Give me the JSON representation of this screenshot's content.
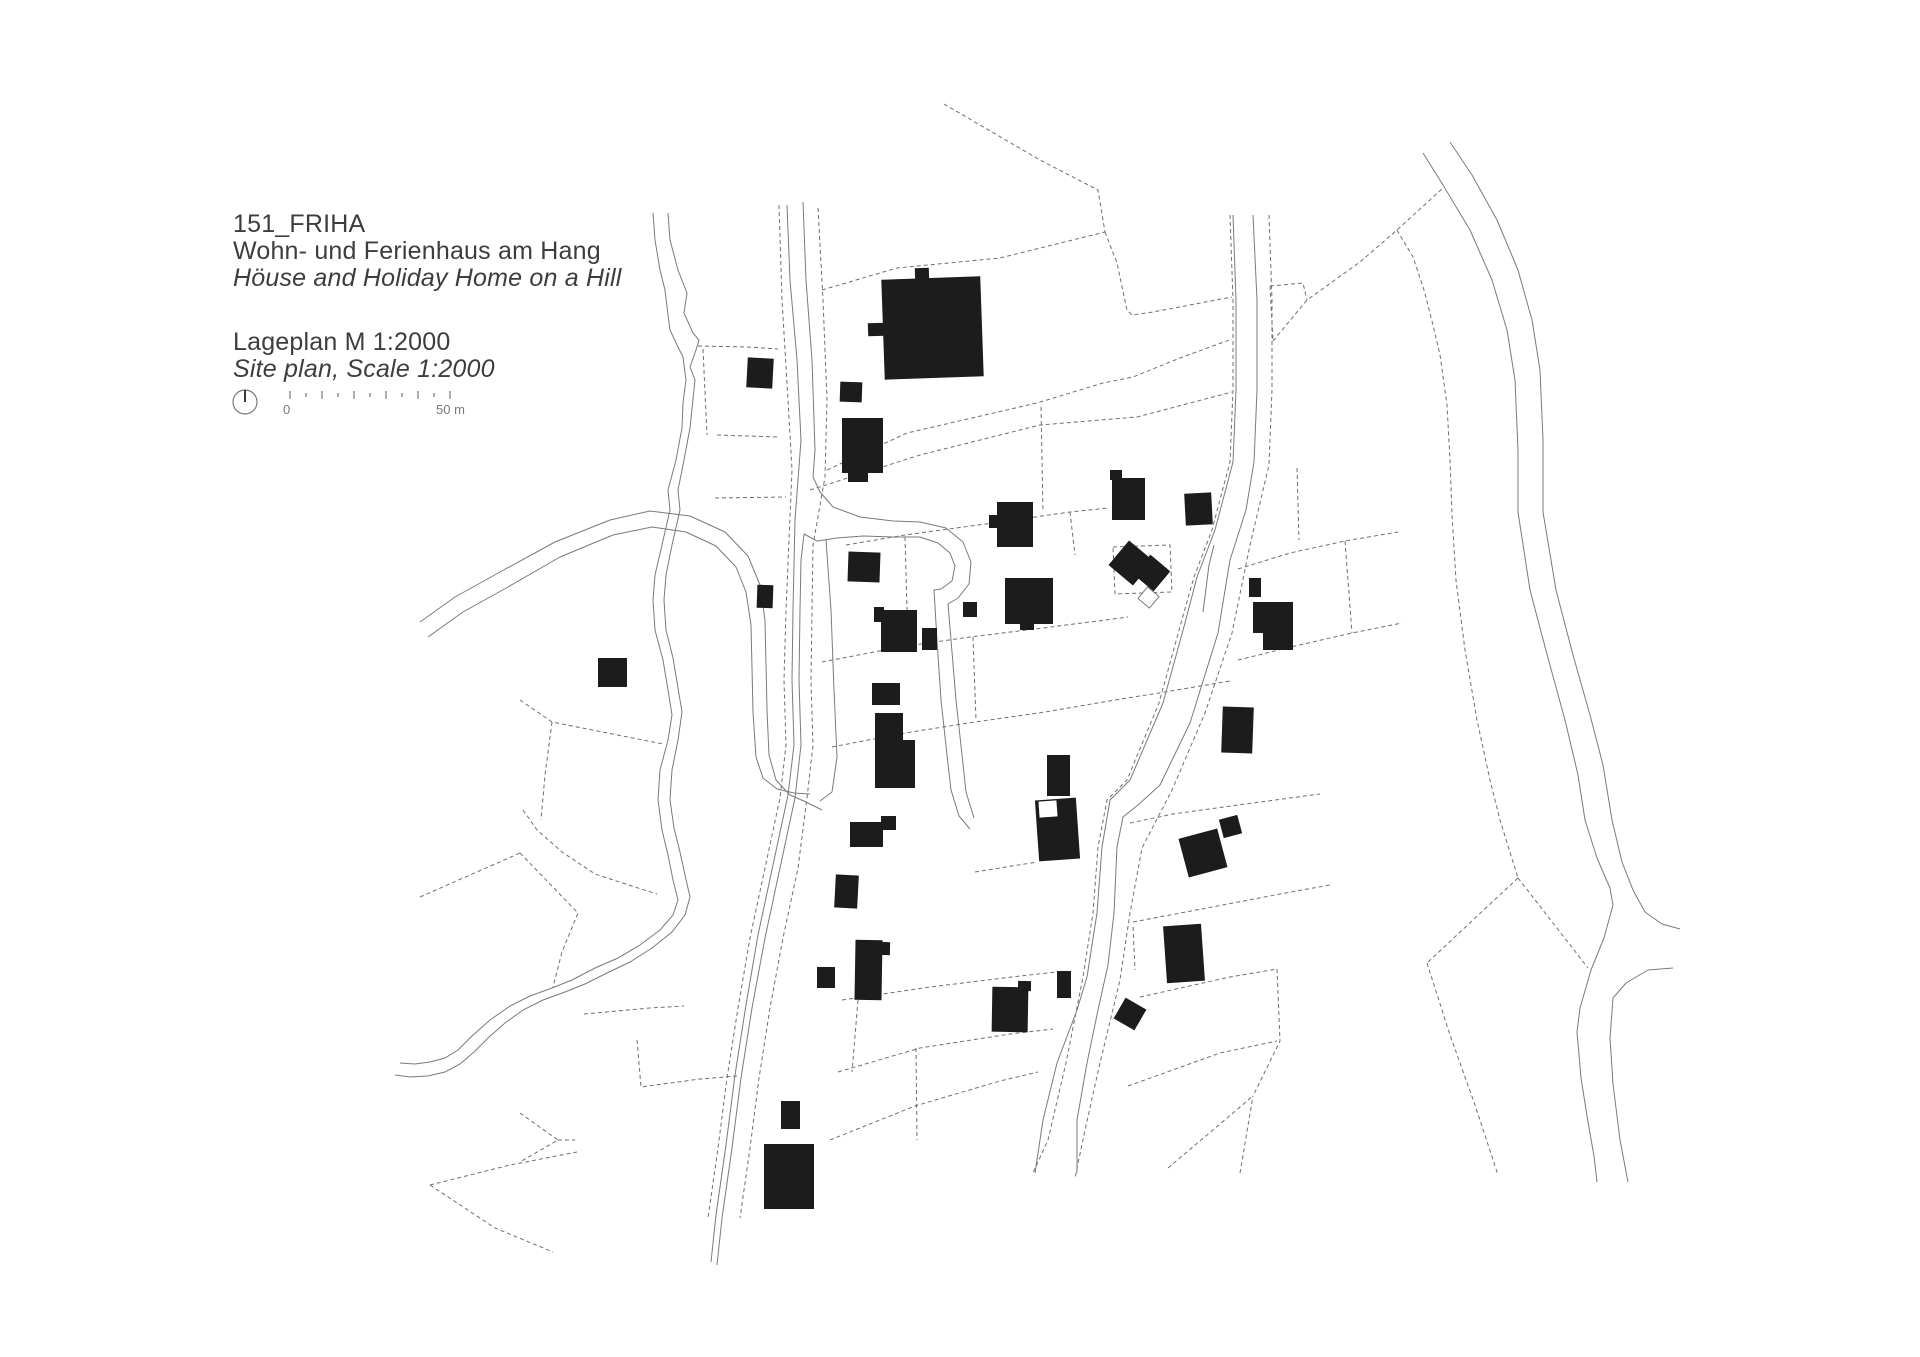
{
  "title_block": {
    "project_id": "151_FRIHA",
    "subtitle_de": "Wohn- und Ferienhaus am Hang",
    "subtitle_en": "Höuse and Holiday Home on a Hill",
    "plan_label_de": "Lageplan M 1:2000",
    "plan_label_en": "Site plan, Scale 1:2000"
  },
  "scale_bar": {
    "start_label": "0",
    "end_label": "50 m",
    "tick_count": 11,
    "x_start": 290,
    "tick_step": 16,
    "y_base": 399,
    "tall_tick_h": 8,
    "short_tick_h": 4
  },
  "north_arrow": {
    "cx": 245,
    "cy": 402,
    "r": 12
  },
  "colors": {
    "line": "#7a7a7a",
    "dashed_line": "#6f6f6f",
    "building": "#1c1c1c",
    "text": "#3d3d3d",
    "scale_text": "#787878",
    "background": "#ffffff"
  },
  "drawing": {
    "width": 1920,
    "height": 1357,
    "streams": [
      "M653,213 L655,240 L660,270 L665,290 L667,307 L670,330 L678,347 L683,357 L686,380 L683,403 L682,428 L676,460 L668,490 L670,510 L662,545 L655,575 L653,600 L655,630 L663,660 L668,690 L672,715 L668,740 L660,770 L658,800 L662,830 L668,855 L673,880 L678,900 L673,915 L660,930 L640,945 L618,958 L595,968 L572,980 L552,988 L530,996 L510,1006 L490,1020 L472,1036 L458,1050 L445,1058 L430,1062 L415,1064 L400,1063",
      "M668,213 L670,240 L678,270 L687,293 L684,313 L693,333 L699,340 L696,350 L690,367 L695,380 L690,428 L684,460 L678,490 L680,510 L672,545 L666,575 L664,600 L666,630 L673,658 L678,688 L682,712 L678,740 L672,770 L670,800 L674,828 L680,852 L685,875 L690,897 L685,915 L672,932 L652,948 L630,962 L607,973 L585,984 L565,992 L543,1000 L523,1010 L505,1023 L488,1038 L474,1052 L460,1064 L445,1072 L428,1076 L410,1077 L395,1075"
    ],
    "roads": [
      "M787,205 L790,280 L797,360 L801,440 L798,480 L795,520 L793,610 L792,680 L794,745 L788,795 L773,865 L758,935 L746,1005 L735,1075 L726,1145 L716,1215 L711,1262",
      "M803,202 L806,280 L812,360 L815,450 L813,477 L820,492 L833,507 L860,517 L893,521 L920,522",
      "M920,537 L893,537 L863,536 L837,538 L817,541 L804,534 L801,560 L800,610 L799,680 L801,745 L795,798 L780,868 L765,938 L752,1008 L741,1078 L732,1148 L722,1218 L717,1265",
      "M920,522 L946,528 L963,542 L971,562 L969,584 L958,598 L948,604 L951,640 L956,700 L962,755 L966,792 L974,818",
      "M920,537 L938,543 L950,553 L955,566 L952,581 L941,589 L934,590 L937,640 L941,700 L947,755 L951,790 L959,816 L970,829",
      "M826,540 L831,610 L834,690 L837,757 L832,792 L820,801",
      "M1233,215 L1236,300 L1236,390 L1233,462 L1215,530 L1197,577 L1185,623 L1163,703 L1130,780 L1110,800 L1102,847 L1097,913 L1087,977 L1077,1010 L1057,1063 L1043,1120 L1035,1173",
      "M1253,215 L1257,300 L1257,390 L1254,462 L1246,510 L1230,560 L1218,633 L1190,723 L1160,785 L1138,805 L1123,817 L1117,847 L1114,913 L1108,965 L1098,1010 L1087,1063 L1077,1120 L1077,1173",
      "M1203,612 L1209,565 L1214,545",
      "M1423,153 L1443,185 L1470,230 L1492,280 L1507,330 L1515,380 L1518,450 L1518,512 L1530,590 L1548,658 L1565,720 L1578,775 L1585,820 L1597,858 L1610,888 L1613,905 L1604,938 L1591,970 L1580,1008 L1577,1032 L1581,1078 L1588,1122 L1594,1156 L1597,1182",
      "M1450,142 L1472,175 L1497,220 L1518,270 L1532,320 L1540,370 L1543,440 L1543,512 L1556,590 L1573,655 L1590,715 L1603,765 L1612,820 L1622,862 L1633,890 L1645,912 L1662,924 L1680,929",
      "M1673,968 L1648,970 L1626,983 L1613,998 L1610,1038 L1613,1084 L1620,1140 L1628,1182",
      "M420,622 L455,597 L500,572 L555,542 L610,520 L650,511 L690,516 L725,532 L748,556 L760,585 L765,620 L766,665 L767,710 L769,755 L776,780 L790,795 L806,802 L822,810",
      "M428,637 L463,612 L508,587 L560,557 L613,535 L652,527 L686,532 L716,546 L736,567 L746,592 L751,625 L752,668 L753,712 L756,757 L763,778 L777,789 L794,793 L810,794"
    ],
    "dashed": [
      "M779,205 L782,300 L788,400 L792,470 L789,540 L786,610 L784,680 L786,745 L780,798 L765,868 L750,938 L738,1008 L727,1078 L718,1148 L708,1218",
      "M818,208 L823,300 L827,400 L825,477 L813,545 L812,610 L811,680 L813,745 L807,798 L798,868 L783,938 L770,1008 L759,1078 L750,1148 L740,1218",
      "M698,346 L748,347 L778,349",
      "M703,349 L707,435",
      "M717,435 L778,437",
      "M715,498 L786,497",
      "M822,290 L897,268 L1000,258 L1105,232",
      "M944,104 L1040,160 L1098,190 L1105,232",
      "M1105,232 L1117,263 L1127,310 L1132,315 L1153,312 L1232,297",
      "M827,470 L907,433 L1037,403 L1103,383 L1133,377 L1180,358 L1232,339",
      "M810,490 L920,455 L1040,425 L1137,417 L1232,392",
      "M1273,341 L1307,300 L1360,262 L1397,230 L1443,188",
      "M1397,230 L1413,257 L1424,290 L1433,325 L1440,355 L1447,405 L1450,460 L1452,515 L1456,580 L1465,650 L1477,720 L1490,780 L1500,820 L1518,878",
      "M1518,878 L1473,920 L1427,963",
      "M1518,878 L1553,923 L1588,968",
      "M1427,963 L1450,1035 L1475,1105 L1498,1175",
      "M1270,286 L1303,283 L1307,300",
      "M1270,286 L1273,341",
      "M1230,215 L1233,300 L1233,390 L1230,462 L1212,530 L1194,577 L1181,623 L1159,703 L1127,780 L1107,800 L1098,847 L1093,913 L1083,977 L1066,1063 L1048,1140 L1032,1175",
      "M1269,215 L1272,300 L1272,390 L1269,465 L1250,545 L1232,633 L1205,713 L1172,790 L1142,848 L1130,913 L1120,980 L1100,1063 L1085,1130 L1075,1178",
      "M846,545 L905,535 L1000,522 L1070,512 L1108,508",
      "M1070,512 L1075,555",
      "M822,662 L900,647 L970,637 L1035,629 L1098,621 L1128,617",
      "M832,747 L905,733 L975,722 L1045,712 L1115,700 L1165,692 L1230,681",
      "M1041,407 L1043,512",
      "M905,537 L908,645",
      "M973,637 L976,720",
      "M520,700 L552,722 L663,744",
      "M552,722 L545,775 L541,820",
      "M523,810 L537,830 L562,852 L595,874 L638,888 L657,894",
      "M520,853 L578,913 L562,952 L553,987",
      "M420,897 L520,853",
      "M584,1014 L650,1008 L684,1006",
      "M637,1040 L641,1087 L700,1079 L737,1076",
      "M520,1113 L558,1140 L520,1162",
      "M558,1140 L575,1140",
      "M430,1185 L495,1228 L553,1252",
      "M430,1185 L510,1165 L577,1152",
      "M842,1000 L930,987 L1020,976 L1057,972",
      "M838,1072 L920,1048 L1010,1034 L1053,1029",
      "M830,1140 L915,1106 L1000,1081 L1038,1072",
      "M916,1048 L917,1140",
      "M858,1000 L852,1072",
      "M975,872 L1037,862",
      "M1130,823 L1173,814 L1253,803 L1320,794",
      "M1133,922 L1207,908 L1280,894 L1330,885",
      "M1133,927 L1135,970",
      "M1140,997 L1230,977 L1277,969",
      "M1128,1086 L1220,1053 L1277,1041",
      "M1168,1168 L1253,1096",
      "M1240,1173 L1253,1096",
      "M1277,969 L1280,1041 L1253,1096",
      "M1238,569 L1290,553 L1345,541 L1398,532",
      "M1238,660 L1295,646 L1352,633 L1402,623",
      "M1345,541 L1352,633",
      "M1297,468 L1299,540",
      "M1113,547 L1170,545 L1172,592 L1115,594 Z"
    ],
    "buildings": [
      {
        "x": 883,
        "y": 278,
        "w": 99,
        "h": 100,
        "rot": -2
      },
      {
        "x": 915,
        "y": 268,
        "w": 14,
        "h": 14,
        "rot": -2
      },
      {
        "x": 868,
        "y": 323,
        "w": 17,
        "h": 13,
        "rot": -2
      },
      {
        "x": 840,
        "y": 382,
        "w": 22,
        "h": 20,
        "rot": 2
      },
      {
        "x": 842,
        "y": 418,
        "w": 41,
        "h": 55,
        "rot": 0
      },
      {
        "x": 848,
        "y": 470,
        "w": 20,
        "h": 12,
        "rot": 0
      },
      {
        "x": 747,
        "y": 358,
        "w": 26,
        "h": 30,
        "rot": 3
      },
      {
        "x": 997,
        "y": 502,
        "w": 36,
        "h": 45,
        "rot": 0
      },
      {
        "x": 989,
        "y": 515,
        "w": 9,
        "h": 13,
        "rot": 0
      },
      {
        "x": 1110,
        "y": 470,
        "w": 12,
        "h": 10,
        "rot": 0
      },
      {
        "x": 1112,
        "y": 478,
        "w": 33,
        "h": 42,
        "rot": 0
      },
      {
        "x": 1185,
        "y": 493,
        "w": 27,
        "h": 32,
        "rot": -3
      },
      {
        "x": 1115,
        "y": 547,
        "w": 32,
        "h": 32,
        "rot": 40
      },
      {
        "x": 1139,
        "y": 560,
        "w": 26,
        "h": 26,
        "rot": 40
      },
      {
        "x": 963,
        "y": 602,
        "w": 14,
        "h": 15,
        "rot": 0
      },
      {
        "x": 1005,
        "y": 578,
        "w": 48,
        "h": 46,
        "rot": 0
      },
      {
        "x": 1020,
        "y": 620,
        "w": 14,
        "h": 10,
        "rot": 0
      },
      {
        "x": 848,
        "y": 552,
        "w": 32,
        "h": 30,
        "rot": 2
      },
      {
        "x": 874,
        "y": 607,
        "w": 10,
        "h": 15,
        "rot": 0
      },
      {
        "x": 881,
        "y": 610,
        "w": 36,
        "h": 42,
        "rot": 0
      },
      {
        "x": 922,
        "y": 628,
        "w": 15,
        "h": 22,
        "rot": 0
      },
      {
        "x": 872,
        "y": 683,
        "w": 28,
        "h": 22,
        "rot": 0
      },
      {
        "x": 598,
        "y": 658,
        "w": 29,
        "h": 29,
        "rot": 0
      },
      {
        "x": 757,
        "y": 585,
        "w": 16,
        "h": 23,
        "rot": 2
      },
      {
        "x": 850,
        "y": 822,
        "w": 33,
        "h": 25,
        "rot": 0
      },
      {
        "x": 881,
        "y": 816,
        "w": 15,
        "h": 14,
        "rot": 0
      },
      {
        "x": 835,
        "y": 875,
        "w": 23,
        "h": 33,
        "rot": 3
      },
      {
        "x": 855,
        "y": 940,
        "w": 27,
        "h": 60,
        "rot": 1
      },
      {
        "x": 876,
        "y": 942,
        "w": 14,
        "h": 13,
        "rot": 1
      },
      {
        "x": 817,
        "y": 967,
        "w": 18,
        "h": 21,
        "rot": 0
      },
      {
        "x": 781,
        "y": 1101,
        "w": 19,
        "h": 28,
        "rot": 0
      },
      {
        "x": 764,
        "y": 1144,
        "w": 50,
        "h": 65,
        "rot": 0
      },
      {
        "x": 992,
        "y": 987,
        "w": 36,
        "h": 45,
        "rot": 1
      },
      {
        "x": 1018,
        "y": 981,
        "w": 13,
        "h": 10,
        "rot": 1
      },
      {
        "x": 1057,
        "y": 971,
        "w": 14,
        "h": 27,
        "rot": 0
      },
      {
        "x": 1047,
        "y": 755,
        "w": 23,
        "h": 41,
        "rot": 0
      },
      {
        "x": 1037,
        "y": 799,
        "w": 41,
        "h": 61,
        "rot": -4
      },
      {
        "x": 1183,
        "y": 833,
        "w": 40,
        "h": 40,
        "rot": -15
      },
      {
        "x": 1221,
        "y": 817,
        "w": 19,
        "h": 19,
        "rot": -15
      },
      {
        "x": 1249,
        "y": 578,
        "w": 12,
        "h": 19,
        "rot": 0
      },
      {
        "x": 1222,
        "y": 707,
        "w": 31,
        "h": 46,
        "rot": 2
      },
      {
        "x": 1165,
        "y": 925,
        "w": 38,
        "h": 57,
        "rot": -4
      },
      {
        "x": 1118,
        "y": 1002,
        "w": 24,
        "h": 24,
        "rot": 30
      }
    ],
    "building_polys": [
      "875,713 903,713 903,740 915,740 915,788 875,788",
      "1253,602 1293,602 1293,650 1263,650 1263,633 1253,633"
    ],
    "white_cutouts": [
      {
        "x": 1039,
        "y": 801,
        "w": 18,
        "h": 16,
        "rot": -4
      }
    ],
    "outlined_shapes": [
      {
        "x": 1141,
        "y": 590,
        "w": 15,
        "h": 15,
        "rot": 40
      }
    ]
  }
}
